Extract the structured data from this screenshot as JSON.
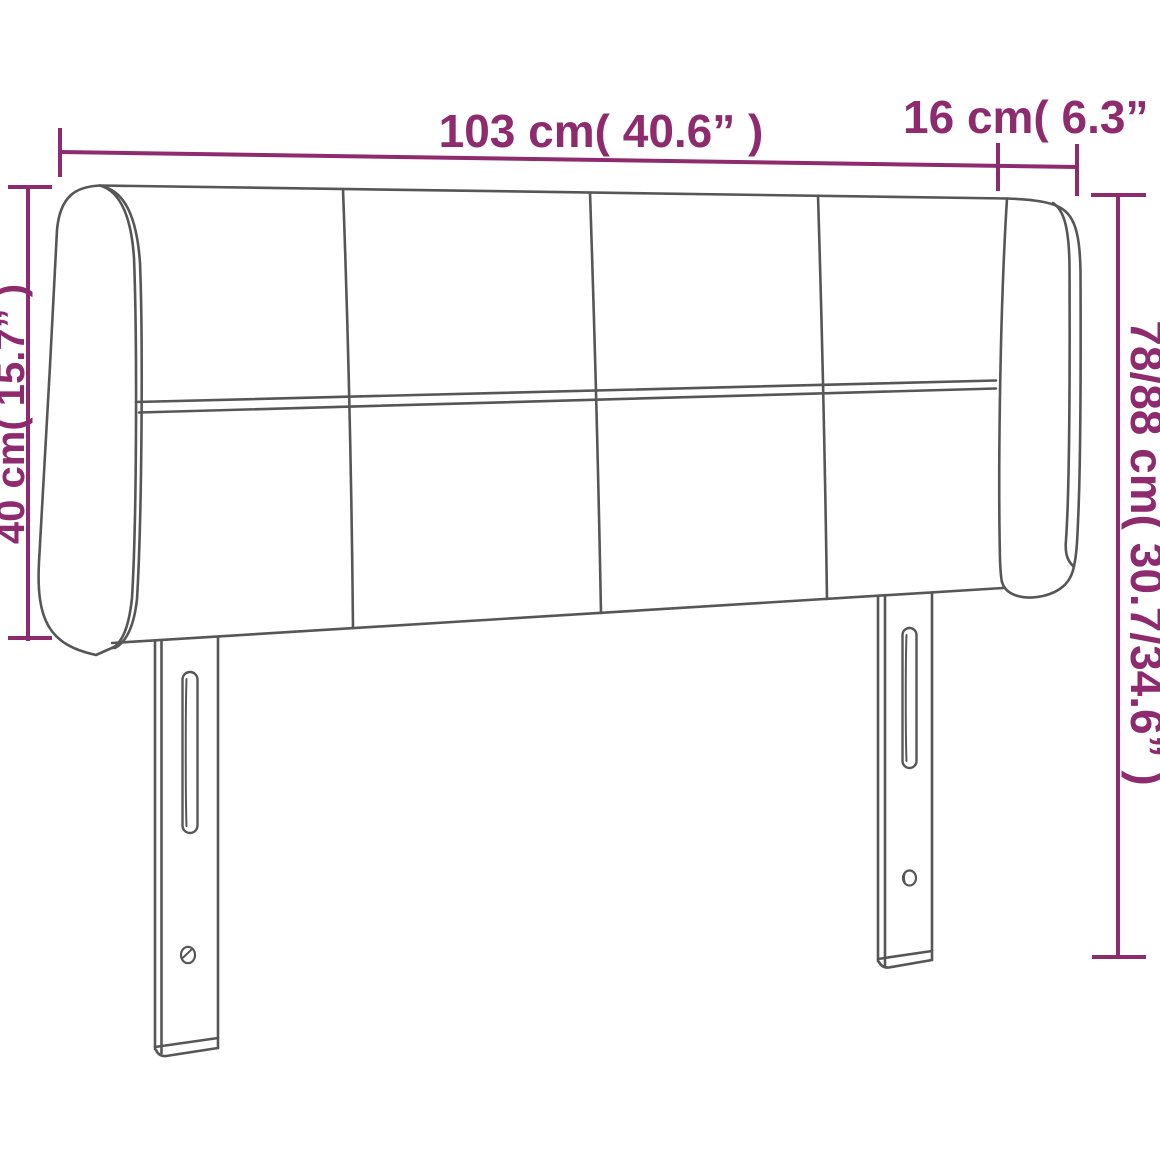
{
  "canvas": {
    "width": 1160,
    "height": 1160,
    "background": "#ffffff"
  },
  "style": {
    "dimension_color": "#8e2a6e",
    "outline_color": "#565656"
  },
  "drawing": {
    "subject": "winged upholstered headboard with four stitched panel columns, horizontal middle seam and two slotted mounting legs"
  },
  "dimensions": {
    "total_width": {
      "text": "103 cm( 40.6” )",
      "cm": "103",
      "inch": "40.6"
    },
    "wing_width": {
      "text": "16 cm( 6.3” )",
      "cm": "16",
      "inch": "6.3"
    },
    "headboard_height": {
      "text": "40 cm( 15.7” )",
      "cm": "40",
      "inch": "15.7"
    },
    "total_height": {
      "text": "78/88 cm( 30.7/34.6” )",
      "cm": "78/88",
      "inch": "30.7/34.6"
    }
  }
}
